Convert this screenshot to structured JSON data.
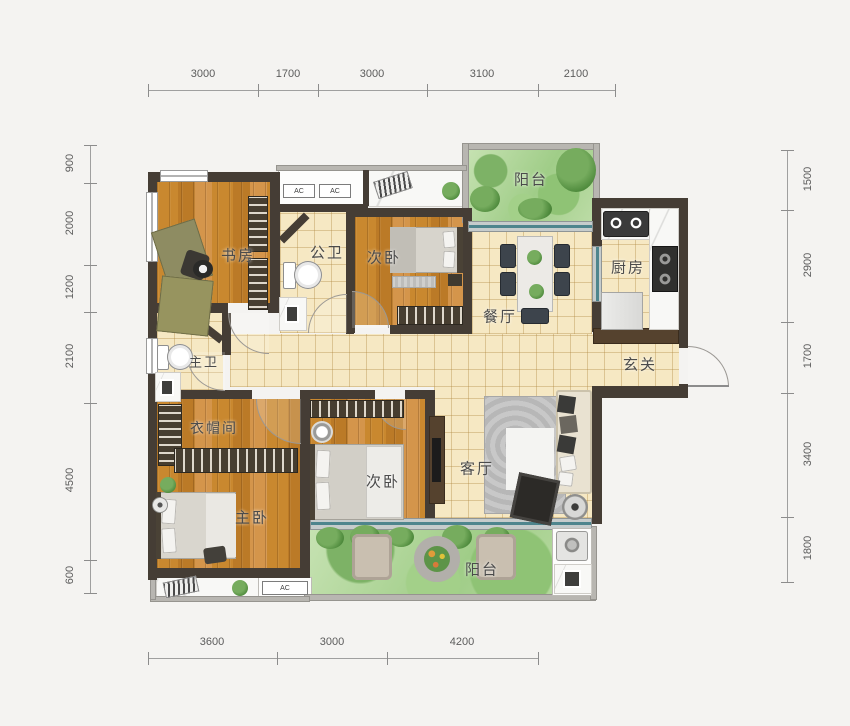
{
  "plan_type": "apartment-floor-plan",
  "rooms": {
    "study": {
      "label": "书房"
    },
    "public_bath": {
      "label": "公卫"
    },
    "bedroom2_top": {
      "label": "次卧"
    },
    "balcony_top": {
      "label": "阳台"
    },
    "dining": {
      "label": "餐厅"
    },
    "kitchen": {
      "label": "厨房"
    },
    "foyer": {
      "label": "玄关"
    },
    "master_bath": {
      "label": "主卫"
    },
    "cloakroom": {
      "label": "衣帽间"
    },
    "master_bedroom": {
      "label": "主卧"
    },
    "bedroom2_bottom": {
      "label": "次卧"
    },
    "living": {
      "label": "客厅"
    },
    "balcony_bottom": {
      "label": "阳台"
    }
  },
  "ac_unit_label": "AC",
  "dims": {
    "top": [
      "3000",
      "1700",
      "3000",
      "3100",
      "2100"
    ],
    "bottom": [
      "3600",
      "3000",
      "4200"
    ],
    "left": [
      "900",
      "2000",
      "1200",
      "2100",
      "4500",
      "600"
    ],
    "right": [
      "1500",
      "2900",
      "1700",
      "3400",
      "1800"
    ]
  },
  "colors": {
    "wall": "#453d35",
    "wood_floor": "#c5832f",
    "tile_floor": "#f6e8c3",
    "balcony_green": "#a8d190",
    "glass": "#4e858d",
    "label_text": "#4b4b4b",
    "dimension_text": "#5c5c5c"
  }
}
